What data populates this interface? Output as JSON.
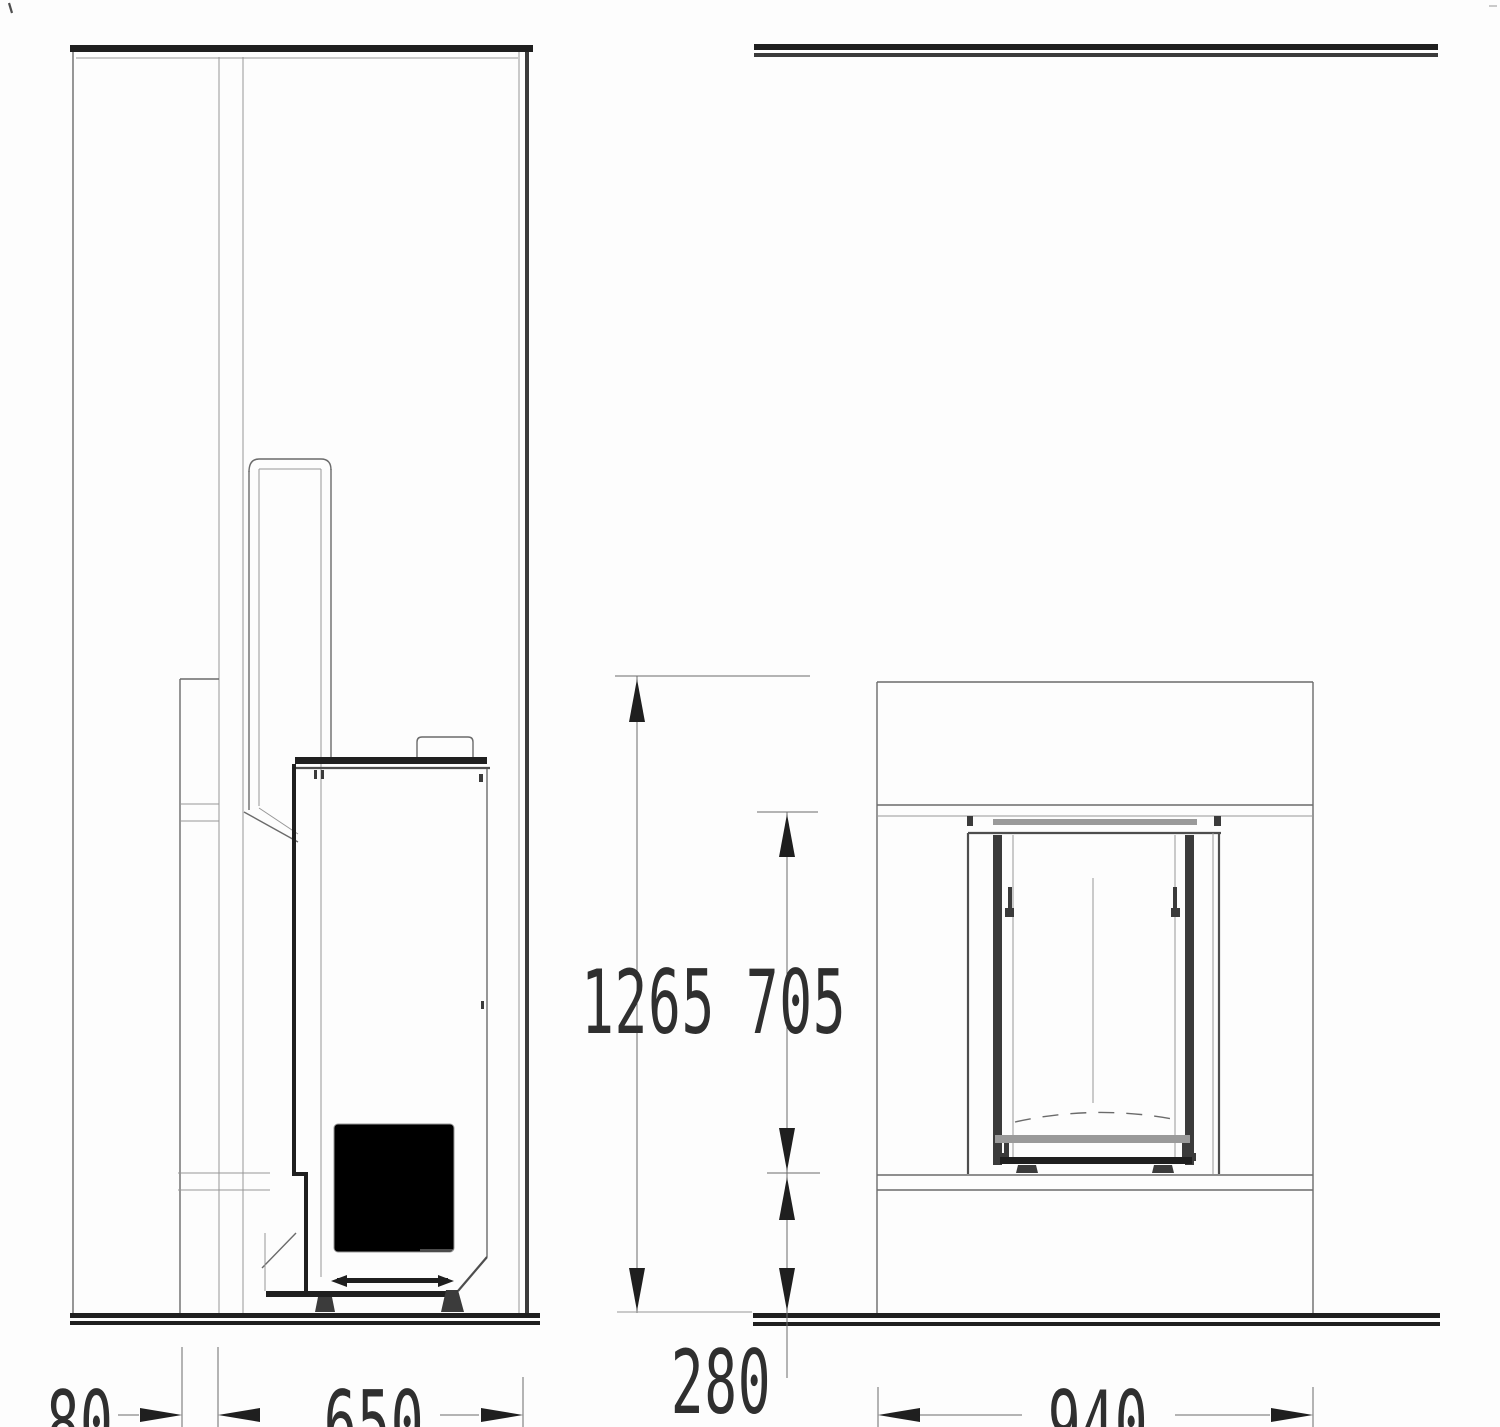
{
  "drawing_type": "fireplace installation drawing, side section and front elevation",
  "dimensions": {
    "total_height": "1265",
    "opening_height": "705",
    "plinth_height": "280",
    "rear_clearance": "80",
    "depth": "650",
    "front_width": "940"
  },
  "colors": {
    "line": "#6b6b6b",
    "line_light": "#979797",
    "line_mid": "#4e4e4e",
    "line_dark": "#2a2a2a",
    "fill_dark": "#1f1f1f",
    "band_gray": "#9a9a9a",
    "bg": "#fdfdfd",
    "text": "#2f2f2f"
  }
}
